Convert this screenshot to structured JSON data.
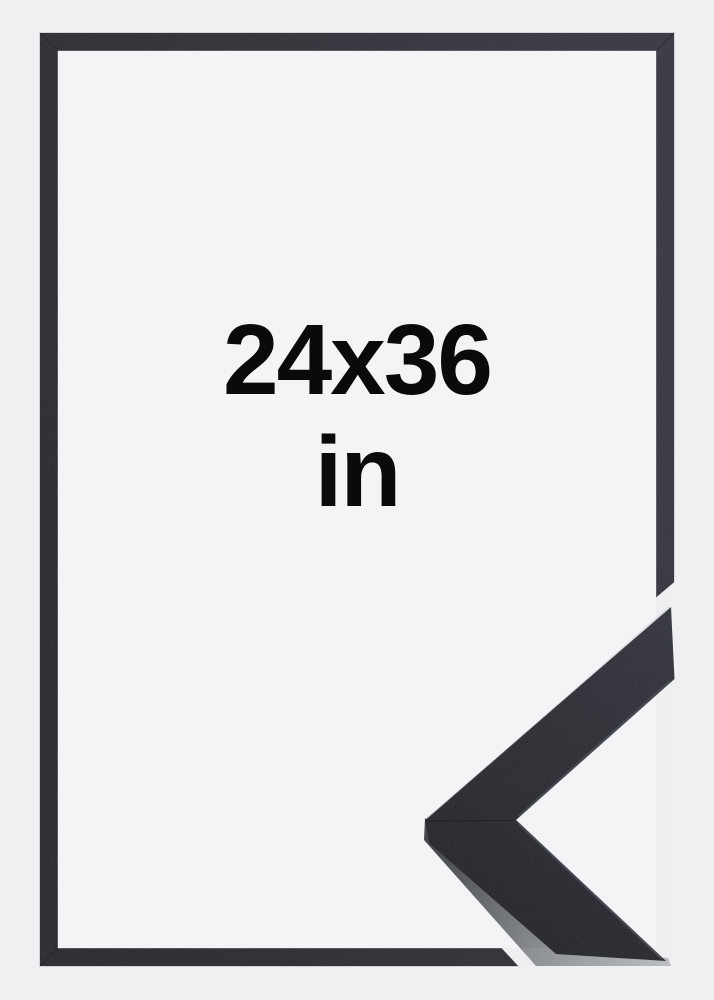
{
  "label": {
    "dimensions": "24x36",
    "unit": "in"
  },
  "colors": {
    "background": "#f0f0f2",
    "frame_opening": "#f4f4f6",
    "frame_black": "#26272c",
    "moulding_top_face": "#26272d",
    "moulding_side_face": "#84888d",
    "label_text": "#0a0a0b"
  }
}
